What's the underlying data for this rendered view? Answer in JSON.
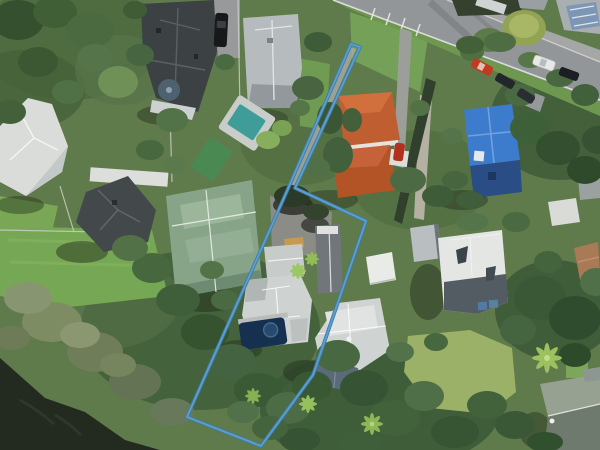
{
  "view": {
    "type": "aerial-imagery",
    "width": 600,
    "height": 450,
    "description": "aerial photo of coastal residential suburb with highlighted flag-shaped parcel"
  },
  "overlay": {
    "parcel_boundary": {
      "color_outer": "#3d7dab",
      "color_inner": "#5fa0cf",
      "points": "351,44 360,47 295,188 366,221 313,375 261,446 187,417 287,191"
    }
  },
  "terrain": {
    "base_green": "#5f7a4b",
    "water_color": "#232b20",
    "lawn_color": "#76a754",
    "pale_lawn_color": "#9cb168",
    "road_color": "#939699",
    "kerb_color": "#e3e4e2",
    "driveway_color": "#97999a",
    "berm_color": "#6e9850",
    "footpath_color": "#a4a7a6",
    "hedge_color": "#31402c",
    "path_pale_color": "#b5b1a2"
  },
  "features": {
    "houses": [
      {
        "id": "white-house-west",
        "roof": "#d9dcd8"
      },
      {
        "id": "dark-villa-north",
        "roof": "#3c4144",
        "turret": "#4e6170"
      },
      {
        "id": "grey-house-north",
        "roof": "#b6bbbd"
      },
      {
        "id": "sage-green-house",
        "roof": "#87a489"
      },
      {
        "id": "dark-house-west",
        "roof": "#43484a"
      },
      {
        "id": "terracotta-house",
        "roof": "#bf5f31"
      },
      {
        "id": "blue-house",
        "roof": "#3d7ccc",
        "walls": "#2a4d85"
      },
      {
        "id": "subject-house",
        "roof": "#ced2d0",
        "garage": "#70767a",
        "deck": "#c79a52"
      },
      {
        "id": "white-shed-east",
        "roof": "#e9ebe7"
      },
      {
        "id": "grey-hip-house-southeast",
        "roof": "#e4e6e4",
        "slope": "#545c63"
      },
      {
        "id": "light-grey-house-south",
        "roof": "#cfd4d3",
        "wing": "#5a6a78"
      },
      {
        "id": "green-roof-house-corner",
        "roof": "#97a192",
        "slope": "#6e7a6e"
      }
    ],
    "pools": [
      {
        "id": "teal-pool",
        "color": "#3f9d99"
      },
      {
        "id": "green-pool",
        "color": "#4a8a52"
      },
      {
        "id": "subject-pool",
        "color": "#16304f",
        "spa": "#274a70"
      }
    ],
    "cars": [
      {
        "id": "red-car-road",
        "color": "#c23b20"
      },
      {
        "id": "white-car-road",
        "color": "#e8e9e6"
      },
      {
        "id": "dark-car-road-1",
        "color": "#23262b"
      },
      {
        "id": "dark-car-road-2",
        "color": "#1b1e22"
      },
      {
        "id": "dark-car-road-3",
        "color": "#2a2d31"
      },
      {
        "id": "black-car-driveway",
        "color": "#17181a"
      },
      {
        "id": "red-car-driveway",
        "color": "#b3301e"
      }
    ]
  }
}
